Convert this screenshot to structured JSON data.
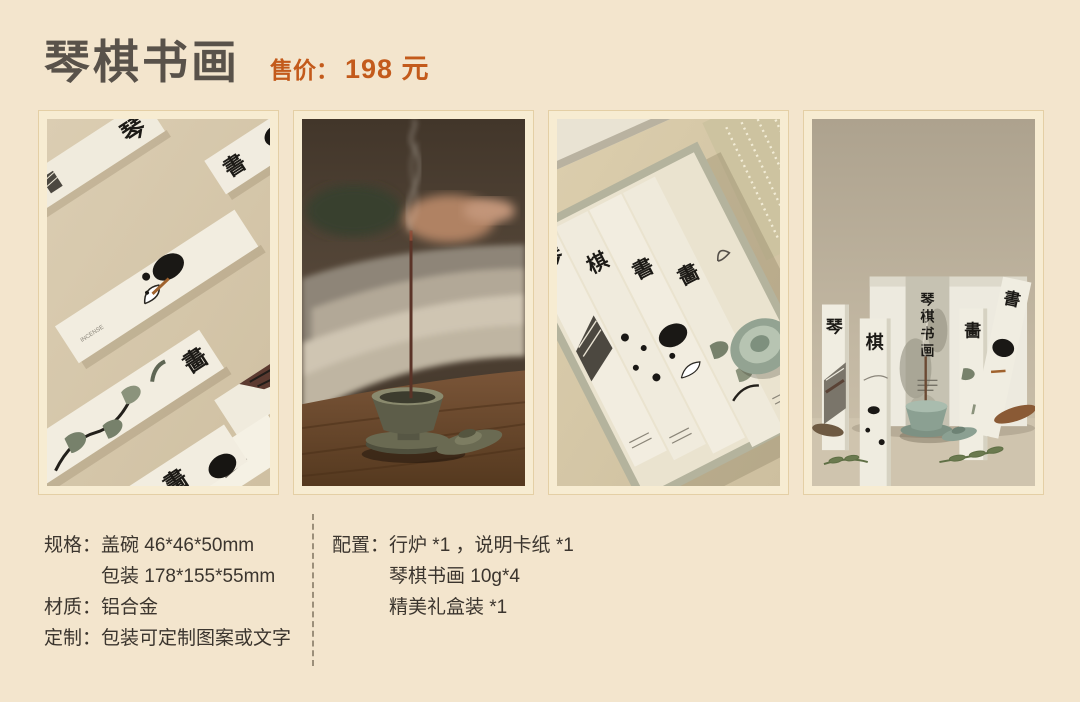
{
  "header": {
    "title": "琴棋书画",
    "price_label": "售价：",
    "price_value": "198 元"
  },
  "specs": {
    "rows": [
      {
        "label": "规格：",
        "value": "盖碗 46*46*50mm"
      },
      {
        "label": "",
        "value": "包装 178*155*55mm"
      },
      {
        "label": "材质：",
        "value": "铝合金"
      },
      {
        "label": "定制：",
        "value": "包装可定制图案或文字"
      }
    ]
  },
  "contents": {
    "label": "配置：",
    "lines": [
      "行炉 *1 ，说明卡纸 *1",
      "琴棋书画 10g*4",
      "精美礼盒装 *1"
    ]
  },
  "photos": [
    {
      "name": "incense-boxes-flatlay",
      "char_qin": "琴",
      "char_shu": "書",
      "char_hua": "畵",
      "char_hua2": "畵",
      "small_text": "INCENSE"
    },
    {
      "name": "burning-incense-by-book"
    },
    {
      "name": "open-gift-box-top-view",
      "char_qin": "琴",
      "char_qi": "棋",
      "char_shu": "書",
      "char_hua": "畵"
    },
    {
      "name": "gift-box-display",
      "band_chars": [
        "琴",
        "棋",
        "书",
        "画"
      ],
      "char_qin": "琴",
      "char_qi": "棋",
      "char_hua": "畵",
      "char_shu": "書"
    }
  ],
  "colors": {
    "page_bg": "#f3e5cd",
    "photo_frame": "#f7ecd2",
    "title_text": "#59524a",
    "price_accent": "#c35a1b",
    "body_text": "#3b352e",
    "divider": "#9b8f7a"
  }
}
